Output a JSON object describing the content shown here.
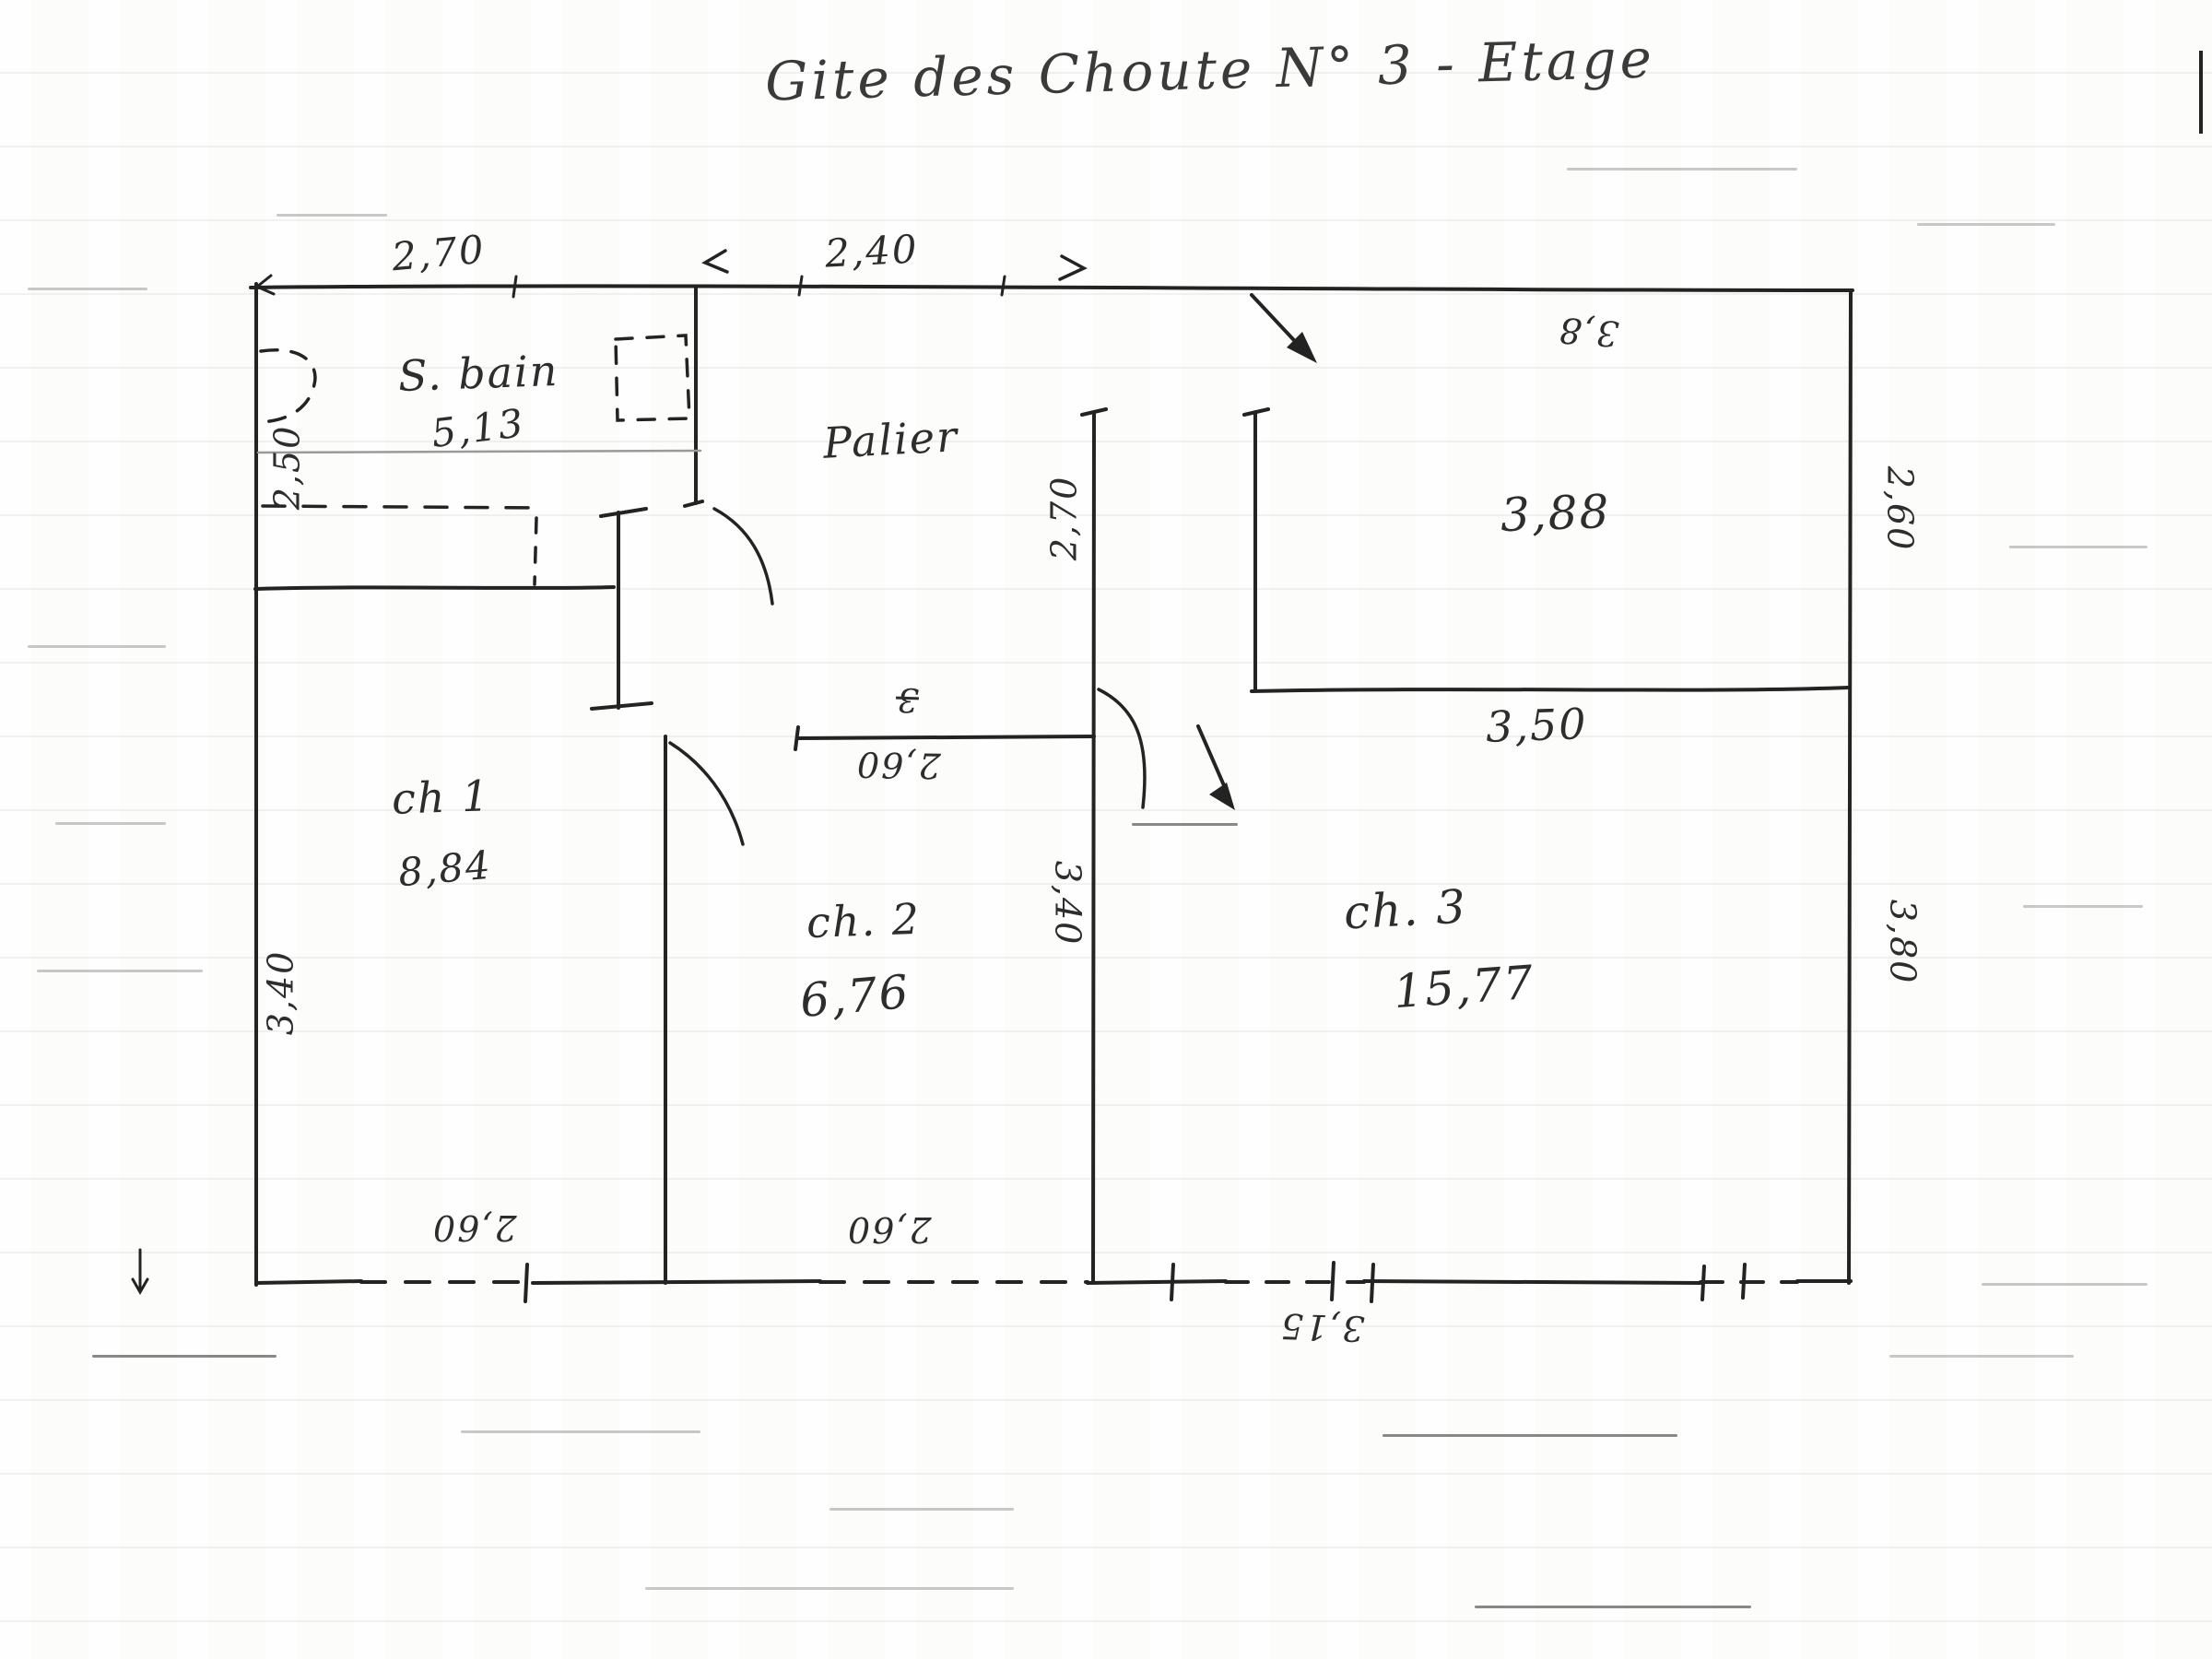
{
  "plan": {
    "title": "Gite des Choute N° 3 - Etage",
    "rooms": {
      "sbain": {
        "name": "S. bain",
        "area": "5,13"
      },
      "palier": {
        "name": "Palier"
      },
      "ch1": {
        "name": "ch 1",
        "area": "8,84"
      },
      "ch2": {
        "name": "ch. 2",
        "area": "6,76"
      },
      "ch3": {
        "name": "ch. 3",
        "area": "15,77"
      },
      "room_ne": {
        "area": "3,88"
      }
    },
    "dims": {
      "top_left": "2,70",
      "top_mid": "2,40",
      "top_right_upside": "3,8",
      "right_upper": "2,60",
      "room_ne_bottom": "3,50",
      "left_upper": "2,50",
      "left_lower": "3,40",
      "palier_east": "2,70",
      "ch2_top": "2,60",
      "ch2_top_mark": "3",
      "ch2_east": "3,40",
      "right_lower": "3,80",
      "bottom_ch1": "2,60",
      "bottom_ch2": "2,60",
      "bottom_right": "3,15"
    }
  }
}
